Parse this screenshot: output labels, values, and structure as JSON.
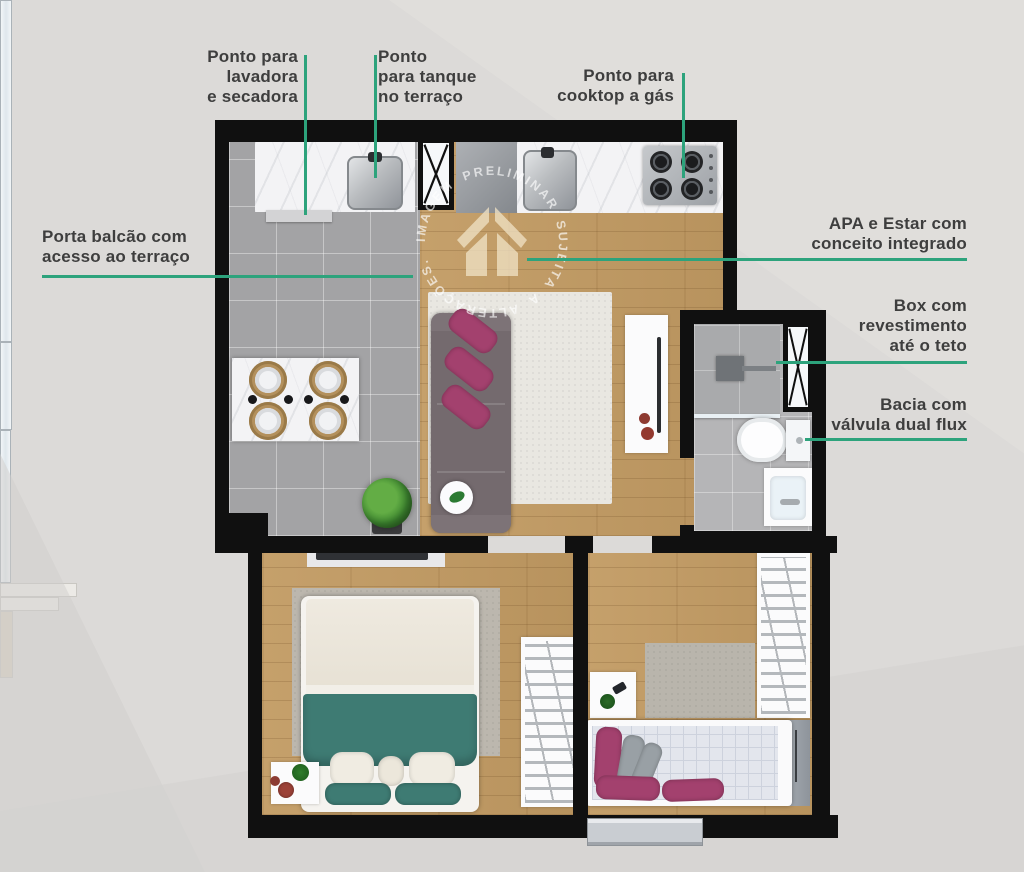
{
  "watermark": {
    "text": "IMAGEM PRELIMINAR SUJEITA A ALTERAÇÕES.",
    "icon": "house-icon"
  },
  "palette": {
    "accent_green": "#2da37c",
    "wall_black": "#101010",
    "wood_floor": "#c29b63",
    "tile_gray": "#a3a3a5",
    "text_dark": "#3e3e3e",
    "background": "#dcdad8",
    "sofa_gray": "#746a6e",
    "pillow_magenta": "#a3416e",
    "blanket_teal": "#3e7b73"
  },
  "callouts": [
    {
      "id": "washer-dryer-point",
      "lines": [
        "Ponto para",
        "lavadora",
        "e secadora"
      ]
    },
    {
      "id": "terrace-tank-point",
      "lines": [
        "Ponto",
        "para tanque",
        "no terraço"
      ]
    },
    {
      "id": "gas-cooktop-point",
      "lines": [
        "Ponto para",
        "cooktop a gás"
      ]
    },
    {
      "id": "balcony-door",
      "lines": [
        "Porta balcão com",
        "acesso ao terraço"
      ]
    },
    {
      "id": "apa-living-integrated",
      "lines": [
        "APA e Estar com",
        "conceito integrado"
      ]
    },
    {
      "id": "shower-box-ceiling",
      "lines": [
        "Box com",
        "revestimento",
        "até o teto"
      ]
    },
    {
      "id": "dual-flush-toilet",
      "lines": [
        "Bacia com",
        "válvula dual flux"
      ]
    }
  ]
}
